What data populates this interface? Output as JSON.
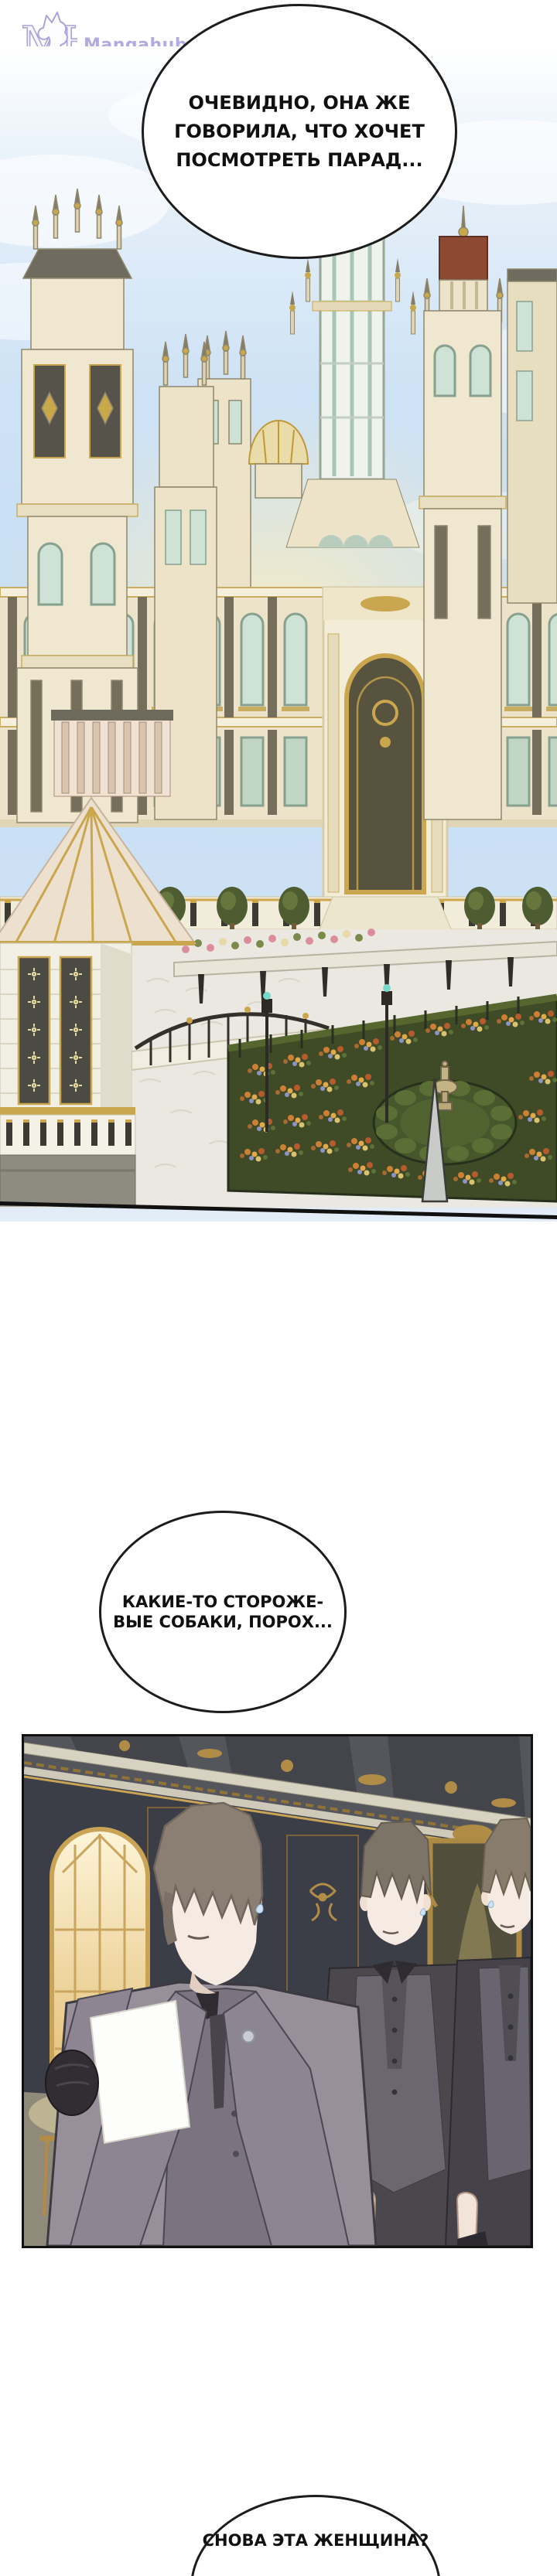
{
  "logo": {
    "monogram": "MH",
    "site_name": "Mangahub.space",
    "color": "#b2abdf"
  },
  "speech_bubbles": [
    {
      "lines": [
        "ОЧЕВИДНО, ОНА ЖЕ",
        "ГОВОРИЛА, ЧТО ХОЧЕТ",
        "ПОСМОТРЕТЬ ПАРАД..."
      ]
    },
    {
      "lines": [
        "КАКИЕ-ТО СТОРОЖЕ-",
        "ВЫЕ СОБАКИ, ПОРОХ..."
      ]
    },
    {
      "lines": [
        "СНОВА ЭТА ЖЕНЩИНА?"
      ]
    }
  ],
  "panels": [
    {
      "name": "palace-parade-scene",
      "description": "Golden baroque palace with towers and a glass clock tower under a pale blue sky; plaza, bridge with pond, and a dense flower garden parterre with hedge circle and urn"
    },
    {
      "name": "servants-hall-scene",
      "description": "Three uniformed male servants with bangs over their eyes standing in an ornate dark hall; the nearest holds a white document in a gloved hand"
    }
  ],
  "colors": {
    "bubble_border": "#1c1c1c",
    "panel_border": "#111111",
    "sky": "#c8def3",
    "palace_cream": "#efe7d0",
    "palace_gold": "#c9a84c",
    "garden_green": "#3f4a27",
    "wall_dark": "#3a3c44"
  }
}
